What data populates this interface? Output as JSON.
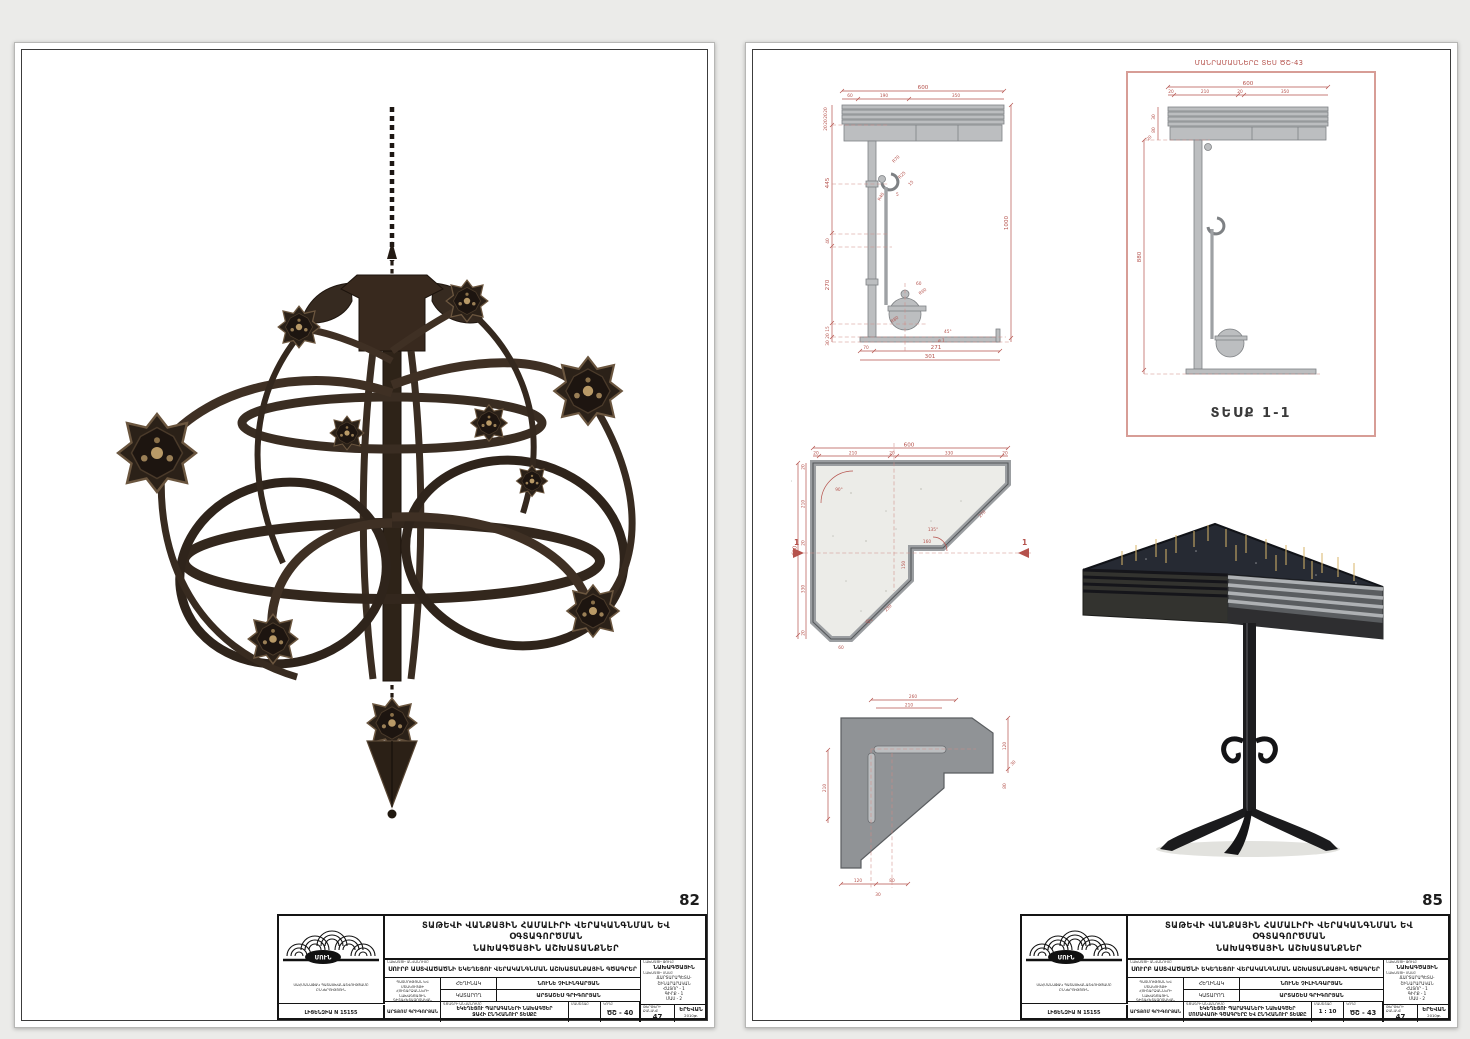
{
  "pages": {
    "left_number": "82",
    "right_number": "85"
  },
  "colors": {
    "dim_red": "#b5524c",
    "box_red": "#d79d96",
    "metal_gray": "#bcbec0",
    "bronze_dark": "#241a12"
  },
  "titleblock": {
    "header1": "ՏԱԹԵՎԻ ՎԱՆՔԱՅԻՆ ՀԱՄԱԼԻՐԻ ՎԵՐԱԿԱՆԳՆՄԱՆ ԵՎ ՕԳՏԱԳՈՐԾՄԱՆ",
    "header2": "ՆԱԽԱԳԾԱՅԻՆ ԱՇԽԱՏԱՆՔՆԵՐ",
    "company": "ՍԱՀՄԱՆԱՓԱԿ ՊԱՏԱՍԽԱՆԱՏՎՈՒԹՅԱՄԲ ԸՆԿԵՐՈՒԹՅՈՒՆ",
    "license": "ԼԻՑԵՆԶԻԱ N 15155",
    "signature": "ԱՐՏՅՈՄ ԳՐԻԳՈՐՅԱՆ",
    "logo_text": "ՄՈՒՆ",
    "org_small": "ՊԱՏՄՈՒԹՅԱՆ ԵՎ ՄՇԱԿՈՒՅԹԻ ՀՈՒՇԱՐՁԱՆՆԵՐԻ ՆԱԽԱԳԾԱՅԻՆ ԳԻՏԱՀԵՏԱԶՈՏԱԿԱՆ ՎԱՐՉՈՒԹՅՈՒՆ",
    "project_label": "ՆԱԽԱԳԾԻ ԱՆՎԱՆՈՒՄԸ",
    "project": "ՍՈՒՐԲ ԱՍՏՎԱԾԱԾՆԻ ԵԿԵՂԵՑՈՒ ՎԵՐԱԿԱՆԳՆՄԱՆ ԱՇԽԱՏԱՆՔԱՅԻՆ ԳԾԱԳՐԵՐ",
    "author_label": "ՀԵՂԻՆԱԿ",
    "author": "ՆՈՒՆԵ ՉԻԼԻՆԳԱՐՅԱՆ",
    "performer_label": "ԿԱՏԱՐՈՂ",
    "performer": "ԱՐՏԱՇԵՍ ԳՐԻԳՈՐՅԱՆ",
    "drawing_label": "ԳԾԱԳՐԻ ԱՆՎԱՆՈՒՄԸ",
    "stage_label": "ՆԱԽԱԳԾԻ ՓՈՒԼԸ",
    "stage": "ՆԱԽԱԳԾԱՅԻՆ",
    "part_label": "ՆԱԽԱԳԾԻ ՄԱՍԸ",
    "part1": "ՃԱՐՏԱՐԱՊԵՏԱ-",
    "part2": "ՇԻՆԱՐԱՐԱԿԱՆ",
    "part3": "ՀԱՏՈՐ - 1",
    "part4": "ԳԻՐՔ - 1",
    "part5": "ՄԱՍ - 2",
    "scale_label": "ՄԱՍՇՏԱԲ",
    "code_label": "ԿՈԴԸ",
    "sheets_label": "ԹԵՐԹԵՐԻ ՔԱՆԱԿԸ",
    "sheets_value": "47",
    "city": "ԵՐԵՎԱՆ",
    "year": "2010թ."
  },
  "left_sheet": {
    "title1": "ԵԿԵՂԵՑՈՒ ՊԱՐԱԳԱՆԵՐԻ ՆԱԽԱԳԾԵՐ",
    "title2": "ՋԱՀԻ ԸՆԴՀԱՆՈՒՐ ՏԵՍՔԸ",
    "code": "ԾՇ - 40",
    "scale": ""
  },
  "right_sheet": {
    "title1": "ԵԿԵՂԵՑՈՒ ՊԱՐԱԳԱՆԵՐԻ ՆԱԽԱԳԾԵՐ",
    "title2": "ՄՈՄԱՎԱՌԻ ԳԾԱԳՐԵՐԸ ԵՎ ԸՆԴՀԱՆՈՒՐ ՏԵՍՔԸ",
    "code": "ԾՇ - 43",
    "scale": "1 : 10",
    "note": "ՄԱՆՐԱՄԱՍՆԵՐԸ ՏԵՍ ԾՇ-43",
    "section_caption": "ՏԵՍՔ 1-1"
  },
  "sec_a": {
    "top0": "600",
    "top1": "60",
    "top2": "190",
    "top3": "350",
    "l0": "20",
    "l1": "20",
    "l2": "20",
    "l3": "20",
    "l4": "445",
    "l5": "40",
    "l6": "270",
    "l7": "15",
    "l8": "20",
    "l9": "30",
    "right0": "1000",
    "b0": "70",
    "b1": "271",
    "b2": "301",
    "c0": "R70",
    "c1": "R25",
    "c2": "15",
    "c3": "R40",
    "c4": "5",
    "c5": "R60",
    "c6": "R80",
    "c7": "45°",
    "c8": "ø 1",
    "c9": "60"
  },
  "sec_b": {
    "top0": "600",
    "top1": "20",
    "top2": "210",
    "top3": "20",
    "top4": "350",
    "l0": "30",
    "l1": "80",
    "l2": "20",
    "h": "880"
  },
  "plan": {
    "t0": "600",
    "t1": "20",
    "t2": "210",
    "t3": "20",
    "t4": "330",
    "t5": "20",
    "lf0": "600",
    "lf1": "20",
    "lf2": "210",
    "lf3": "20",
    "lf4": "330",
    "lf5": "20",
    "i0": "160",
    "i1": "150",
    "i2": "230",
    "i3": "270",
    "a0": "90°",
    "a1": "135°",
    "a2": "45°",
    "b0": "60",
    "flag": "1"
  },
  "detail": {
    "t0": "260",
    "t1": "210",
    "lf0": "210",
    "r0": "120",
    "r1": "30",
    "r2": "80",
    "b0": "120",
    "b1": "80",
    "b2": "30"
  }
}
